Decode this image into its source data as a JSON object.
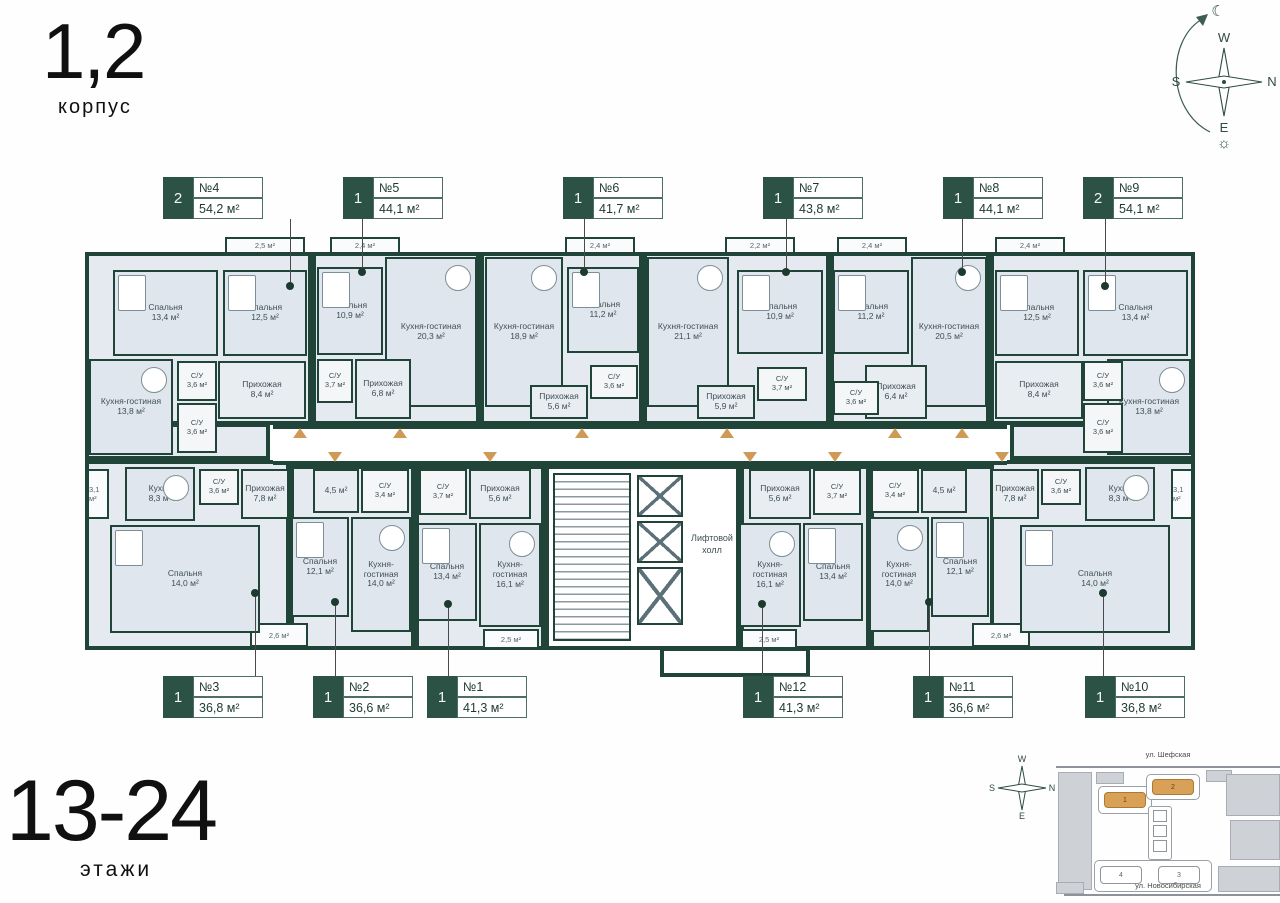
{
  "header": {
    "building": "1,2",
    "label": "корпус"
  },
  "floors": {
    "range": "13-24",
    "label": "этажи"
  },
  "compass": {
    "west": "W",
    "south": "S",
    "north": "N",
    "east": "E",
    "moon": "☾",
    "sun": "☼"
  },
  "core": {
    "label": "Лифтовой холл"
  },
  "colors": {
    "wall": "#204437",
    "room_fill": "#dfe6ee",
    "accent_arrow": "#cf9a55",
    "tag_green": "#2b5244",
    "map_highlight": "#d9a057"
  },
  "site_map": {
    "street_top": "ул. Шефская",
    "street_bottom": "ул. Новосибирская",
    "b1": "1",
    "b2": "2",
    "b3": "3",
    "b4": "4"
  },
  "apartments": [
    {
      "number": "№4",
      "area": "54,2 м²",
      "room_count": "2",
      "rooms": [
        {
          "name": "Спальня",
          "area": "13,4 м²"
        },
        {
          "name": "Спальня",
          "area": "12,5 м²"
        },
        {
          "name": "Кухня-гостиная",
          "area": "13,8 м²"
        },
        {
          "name": "Прихожая",
          "area": "8,4 м²"
        },
        {
          "name": "С/У",
          "area": "3,6 м²"
        },
        {
          "name": "С/У",
          "area": "3,6 м²"
        },
        {
          "name": "",
          "area": "2,5 м²"
        }
      ]
    },
    {
      "number": "№5",
      "area": "44,1 м²",
      "room_count": "1",
      "rooms": [
        {
          "name": "Спальня",
          "area": "10,9 м²"
        },
        {
          "name": "Кухня-гостиная",
          "area": "20,3 м²"
        },
        {
          "name": "Прихожая",
          "area": "6,8 м²"
        },
        {
          "name": "С/У",
          "area": "3,7 м²"
        },
        {
          "name": "",
          "area": "2,4 м²"
        }
      ]
    },
    {
      "number": "№6",
      "area": "41,7 м²",
      "room_count": "1",
      "rooms": [
        {
          "name": "Кухня-гостиная",
          "area": "18,9 м²"
        },
        {
          "name": "Спальня",
          "area": "11,2 м²"
        },
        {
          "name": "Прихожая",
          "area": "5,6 м²"
        },
        {
          "name": "С/У",
          "area": "3,6 м²"
        },
        {
          "name": "",
          "area": "2,4 м²"
        }
      ]
    },
    {
      "number": "№7",
      "area": "43,8 м²",
      "room_count": "1",
      "rooms": [
        {
          "name": "Кухня-гостиная",
          "area": "21,1 м²"
        },
        {
          "name": "Спальня",
          "area": "10,9 м²"
        },
        {
          "name": "Прихожая",
          "area": "5,9 м²"
        },
        {
          "name": "С/У",
          "area": "3,7 м²"
        },
        {
          "name": "",
          "area": "2,2 м²"
        }
      ]
    },
    {
      "number": "№8",
      "area": "44,1 м²",
      "room_count": "1",
      "rooms": [
        {
          "name": "Спальня",
          "area": "11,2 м²"
        },
        {
          "name": "Кухня-гостиная",
          "area": "20,5 м²"
        },
        {
          "name": "Прихожая",
          "area": "6,4 м²"
        },
        {
          "name": "С/У",
          "area": "3,6 м²"
        },
        {
          "name": "",
          "area": "2,4 м²"
        }
      ]
    },
    {
      "number": "№9",
      "area": "54,1 м²",
      "room_count": "2",
      "rooms": [
        {
          "name": "Спальня",
          "area": "12,5 м²"
        },
        {
          "name": "Спальня",
          "area": "13,4 м²"
        },
        {
          "name": "Кухня-гостиная",
          "area": "13,8 м²"
        },
        {
          "name": "Прихожая",
          "area": "8,4 м²"
        },
        {
          "name": "С/У",
          "area": "3,6 м²"
        },
        {
          "name": "С/У",
          "area": "3,6 м²"
        },
        {
          "name": "",
          "area": "2,4 м²"
        }
      ]
    },
    {
      "number": "№3",
      "area": "36,8 м²",
      "room_count": "1",
      "rooms": [
        {
          "name": "Кухня",
          "area": "8,3 м²"
        },
        {
          "name": "С/У",
          "area": "3,6 м²"
        },
        {
          "name": "Прихожая",
          "area": "7,8 м²"
        },
        {
          "name": "Спальня",
          "area": "14,0 м²"
        },
        {
          "name": "",
          "area": "3,1 м²"
        }
      ]
    },
    {
      "number": "№2",
      "area": "36,6 м²",
      "room_count": "1",
      "rooms": [
        {
          "name": "",
          "area": "4,5 м²"
        },
        {
          "name": "С/У",
          "area": "3,4 м²"
        },
        {
          "name": "Спальня",
          "area": "12,1 м²"
        },
        {
          "name": "Кухня-гостиная",
          "area": "14,0 м²"
        },
        {
          "name": "",
          "area": "2,6 м²"
        }
      ]
    },
    {
      "number": "№1",
      "area": "41,3 м²",
      "room_count": "1",
      "rooms": [
        {
          "name": "С/У",
          "area": "3,7 м²"
        },
        {
          "name": "Прихожая",
          "area": "5,6 м²"
        },
        {
          "name": "Спальня",
          "area": "13,4 м²"
        },
        {
          "name": "Кухня-гостиная",
          "area": "16,1 м²"
        },
        {
          "name": "",
          "area": "2,5 м²"
        }
      ]
    },
    {
      "number": "№12",
      "area": "41,3 м²",
      "room_count": "1",
      "rooms": [
        {
          "name": "Прихожая",
          "area": "5,6 м²"
        },
        {
          "name": "С/У",
          "area": "3,7 м²"
        },
        {
          "name": "Кухня-гостиная",
          "area": "16,1 м²"
        },
        {
          "name": "Спальня",
          "area": "13,4 м²"
        },
        {
          "name": "",
          "area": "2,5 м²"
        }
      ]
    },
    {
      "number": "№11",
      "area": "36,6 м²",
      "room_count": "1",
      "rooms": [
        {
          "name": "С/У",
          "area": "3,4 м²"
        },
        {
          "name": "",
          "area": "4,5 м²"
        },
        {
          "name": "Кухня-гостиная",
          "area": "14,0 м²"
        },
        {
          "name": "Спальня",
          "area": "12,1 м²"
        },
        {
          "name": "",
          "area": "2,6 м²"
        }
      ]
    },
    {
      "number": "№10",
      "area": "36,8 м²",
      "room_count": "1",
      "rooms": [
        {
          "name": "Прихожая",
          "area": "7,8 м²"
        },
        {
          "name": "С/У",
          "area": "3,6 м²"
        },
        {
          "name": "Кухня",
          "area": "8,3 м²"
        },
        {
          "name": "Спальня",
          "area": "14,0 м²"
        },
        {
          "name": "",
          "area": "3,1 м²"
        }
      ]
    }
  ]
}
